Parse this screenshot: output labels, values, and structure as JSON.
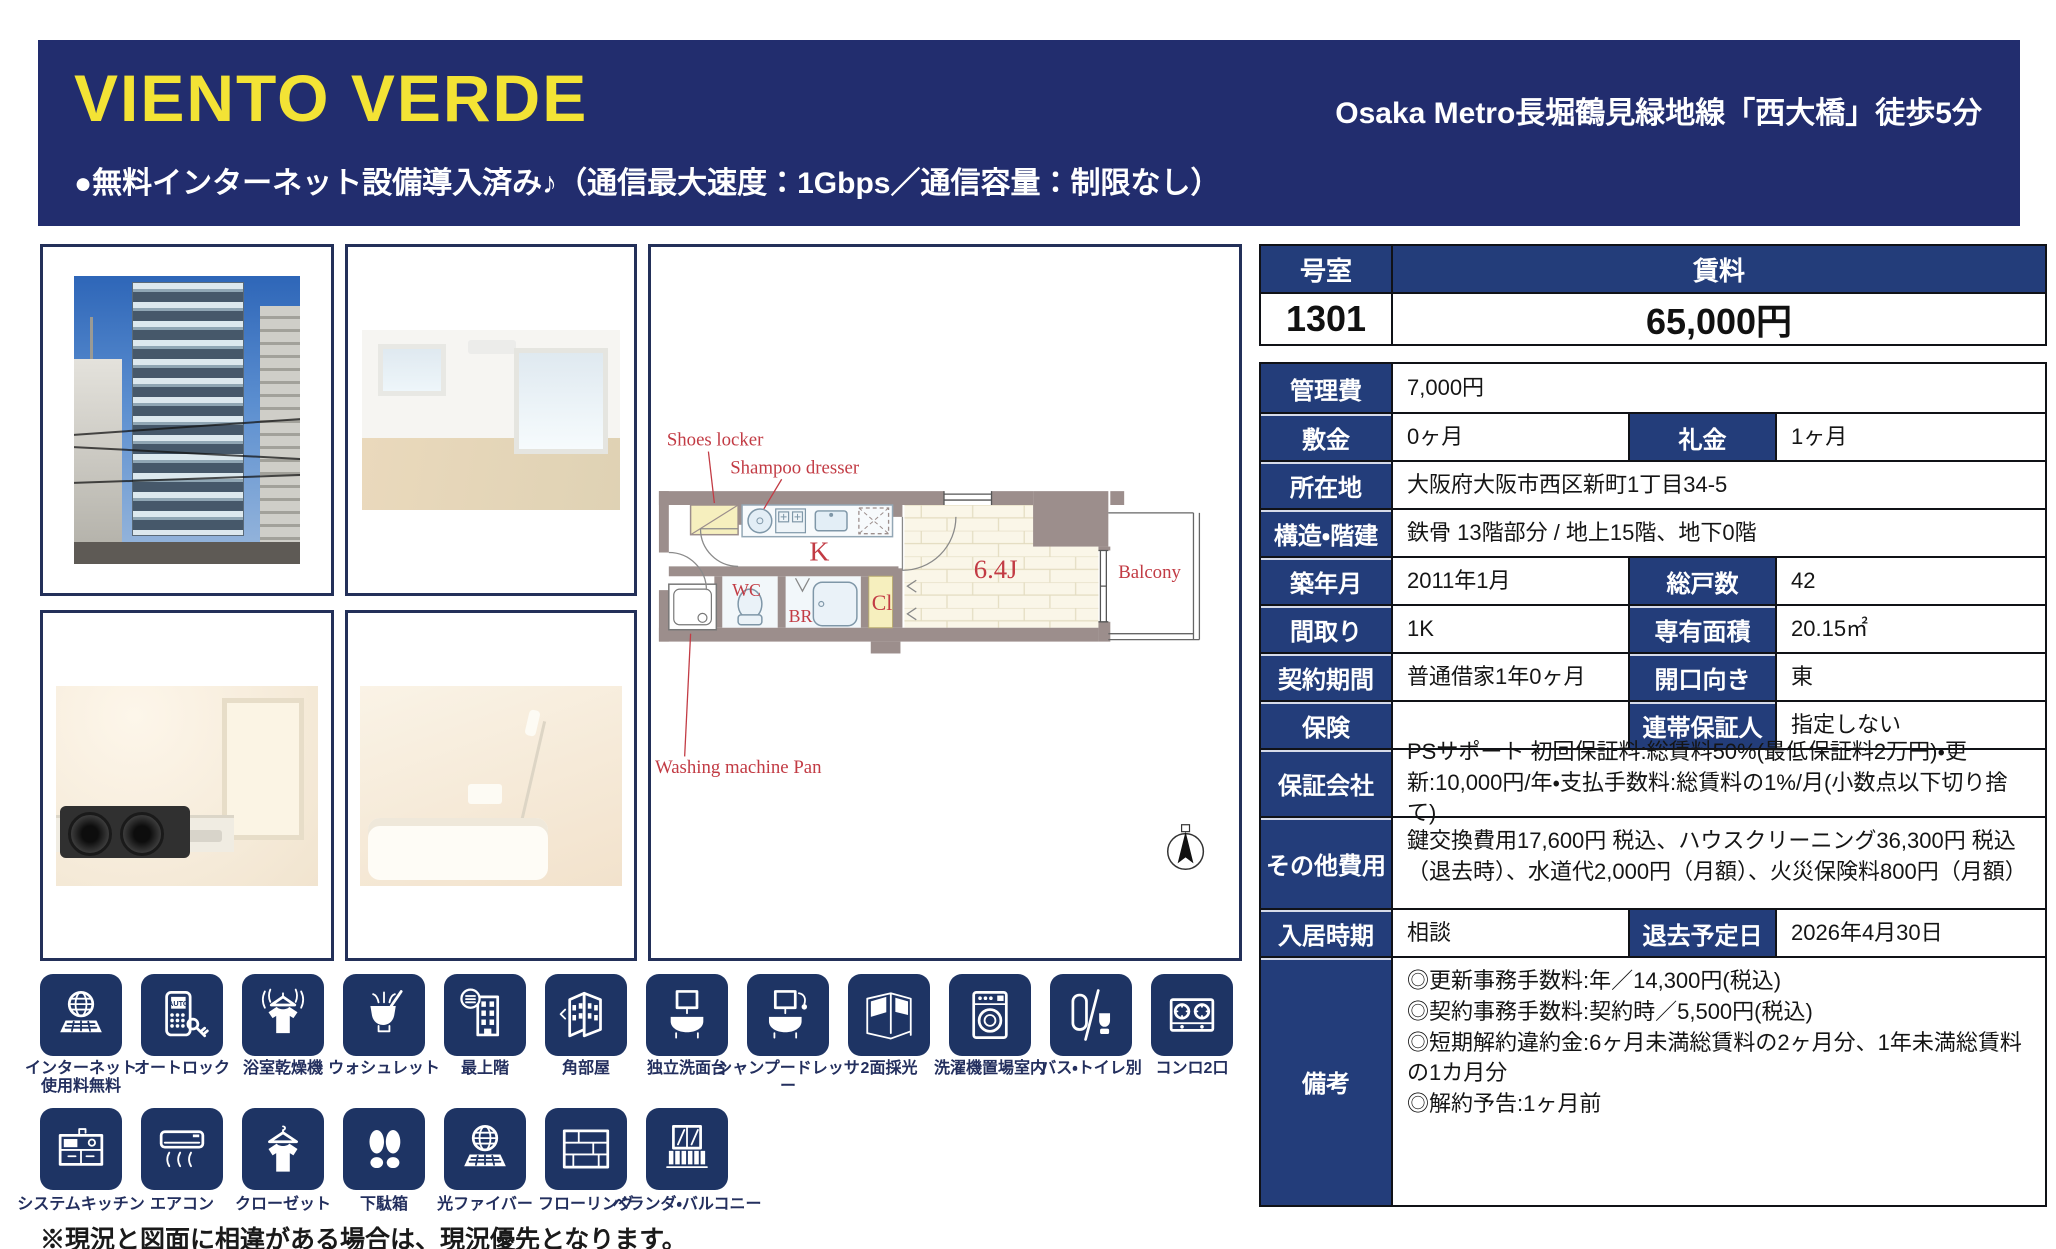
{
  "header": {
    "title": "VIENTO VERDE",
    "subtitle": "●無料インターネット設備導入済み♪（通信最大速度：1Gbps／通信容量：制限なし）",
    "station": "Osaka Metro長堀鶴見緑地線「西大橋」徒歩5分",
    "bg_color": "#222d6e",
    "title_color": "#f3e335"
  },
  "photos": [
    {
      "name": "building-exterior"
    },
    {
      "name": "living-room"
    },
    {
      "name": "kitchen"
    },
    {
      "name": "bathroom"
    }
  ],
  "floorplan": {
    "labels": {
      "shoes": "Shoes locker",
      "shampoo": "Shampoo dresser",
      "washing": "Washing machine Pan",
      "k": "K",
      "wc": "WC",
      "br": "BR",
      "cl": "Cl",
      "room": "6.4J",
      "balcony": "Balcony"
    },
    "label_color": "#c23b44"
  },
  "summary": {
    "room_no_label": "号室",
    "room_no": "1301",
    "rent_label": "賃料",
    "rent": "65,000円"
  },
  "details": {
    "kanrihi": {
      "label": "管理費",
      "value": "7,000円"
    },
    "shikikin": {
      "label": "敷金",
      "value": "0ヶ月"
    },
    "reikin": {
      "label": "礼金",
      "value": "1ヶ月"
    },
    "shozaichi": {
      "label": "所在地",
      "value": "大阪府大阪市西区新町1丁目34-5"
    },
    "kozo": {
      "label": "構造・階建",
      "value": "鉄骨 13階部分 / 地上15階、地下0階"
    },
    "chikunengetsu": {
      "label": "築年月",
      "value": "2011年1月"
    },
    "sokosu": {
      "label": "総戸数",
      "value": "42"
    },
    "madori": {
      "label": "間取り",
      "value": "1K"
    },
    "menseki": {
      "label": "専有面積",
      "value": "20.15㎡"
    },
    "keiyaku": {
      "label": "契約期間",
      "value": "普通借家1年0ヶ月"
    },
    "kaiko": {
      "label": "開口向き",
      "value": "東"
    },
    "hoken": {
      "label": "保険",
      "value": ""
    },
    "rentai": {
      "label": "連帯保証人",
      "value": "指定しない"
    },
    "hosho": {
      "label": "保証会社",
      "value": "PSサポート 初回保証料:総賃料50%(最低保証料2万円)・更新:10,000円/年・支払手数料:総賃料の1%/月(小数点以下切り捨て)"
    },
    "sonota": {
      "label": "その他費用",
      "value": "鍵交換費用17,600円 税込、ハウスクリーニング36,300円 税込（退去時）、水道代2,000円（月額）、火災保険料800円（月額）"
    },
    "nyukyo": {
      "label": "入居時期",
      "value": "相談"
    },
    "taikyo": {
      "label": "退去予定日",
      "value": "2026年4月30日"
    },
    "biko": {
      "label": "備考",
      "value": "◎更新事務手数料:年／14,300円(税込)\n◎契約事務手数料:契約時／5,500円(税込)\n◎短期解約違約金:6ヶ月未満総賃料の2ヶ月分、1年未満総賃料の1カ月分\n◎解約予告:1ヶ月前"
    }
  },
  "features_row1": [
    {
      "label": "インターネット\n使用料無料",
      "icon": "internet-icon"
    },
    {
      "label": "オートロック",
      "icon": "autolock-icon"
    },
    {
      "label": "浴室乾燥機",
      "icon": "bathroom-dryer-icon"
    },
    {
      "label": "ウォシュレット",
      "icon": "washlet-icon"
    },
    {
      "label": "最上階",
      "icon": "top-floor-icon"
    },
    {
      "label": "角部屋",
      "icon": "corner-room-icon"
    },
    {
      "label": "独立洗面台",
      "icon": "vanity-icon"
    },
    {
      "label": "シャンプードレッサー",
      "icon": "shampoo-dresser-icon"
    },
    {
      "label": "2面採光",
      "icon": "two-side-light-icon"
    },
    {
      "label": "洗濯機置場室内",
      "icon": "washing-machine-icon"
    },
    {
      "label": "バス・トイレ別",
      "icon": "separate-bath-toilet-icon"
    },
    {
      "label": "コンロ2口",
      "icon": "two-burner-stove-icon"
    }
  ],
  "features_row2": [
    {
      "label": "システムキッチン",
      "icon": "system-kitchen-icon"
    },
    {
      "label": "エアコン",
      "icon": "aircon-icon"
    },
    {
      "label": "クローゼット",
      "icon": "closet-icon"
    },
    {
      "label": "下駄箱",
      "icon": "shoe-box-icon"
    },
    {
      "label": "光ファイバー",
      "icon": "optical-fiber-icon"
    },
    {
      "label": "フローリング",
      "icon": "flooring-icon"
    },
    {
      "label": "ベランダ・バルコニー",
      "icon": "veranda-balcony-icon"
    }
  ],
  "footer_note": "※現況と図面に相違がある場合は、現況優先となります。",
  "colors": {
    "table_navy": "#233d7a",
    "tile_navy": "#1e3464",
    "border_dark": "#101217",
    "accent_red": "#c23b44",
    "wall_gray": "#9c8e8c"
  }
}
